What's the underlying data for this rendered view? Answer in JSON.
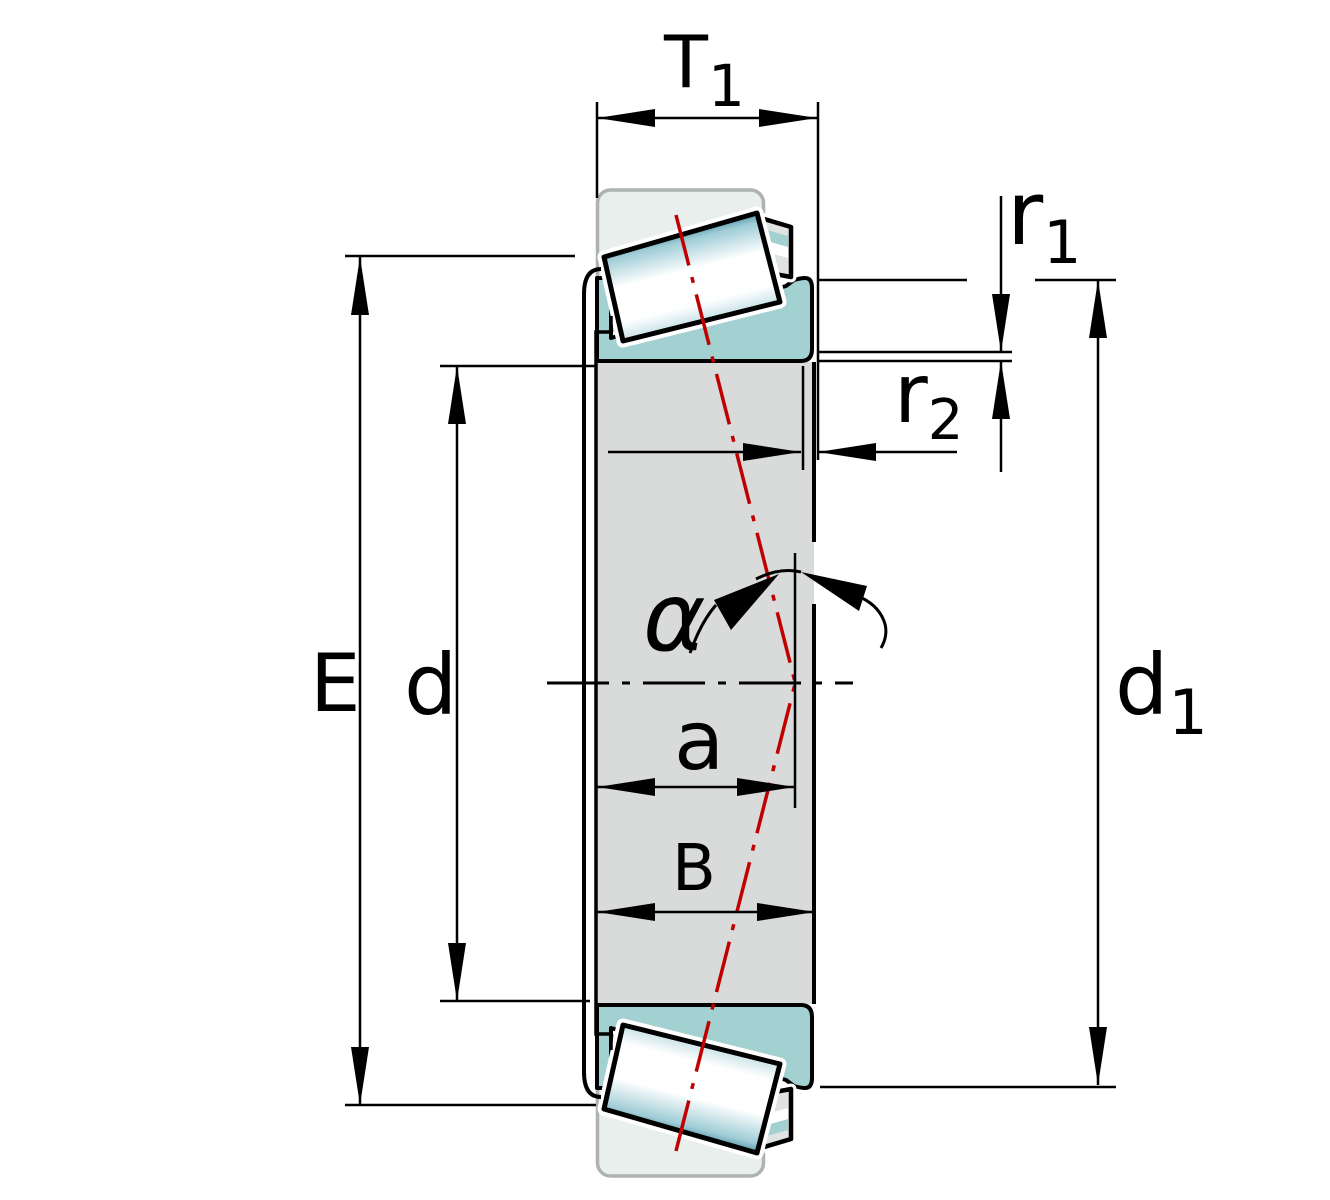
{
  "diagram": {
    "type": "technical-drawing",
    "subject": "Tapered roller bearing cross-section with dimension annotations (cone assembly with rollers and cage, outer section shown phantom)",
    "labels": {
      "T1": {
        "main": "T",
        "sub": "1"
      },
      "r1": {
        "main": "r",
        "sub": "1"
      },
      "r2": {
        "main": "r",
        "sub": "2"
      },
      "d1": {
        "main": "d",
        "sub": "1"
      },
      "E": "E",
      "d": "d",
      "a": "a",
      "B": "B",
      "alpha": "α"
    },
    "colors": {
      "outline": "#000000",
      "dimension_lines": "#000000",
      "inner_ring_teal": "#a3d0d0",
      "bore_gray": "#d9dbdb",
      "cage_bar_gray": "#dfe3e2",
      "phantom_fill": "#e9efec",
      "phantom_border": "#aeb3b1",
      "roller_teal_dark": "#3f8b9b",
      "roller_teal_light": "#9fccd6",
      "roller_highlight": "#ffffff",
      "roller_axis_red": "#c00000",
      "background": "#ffffff"
    }
  }
}
